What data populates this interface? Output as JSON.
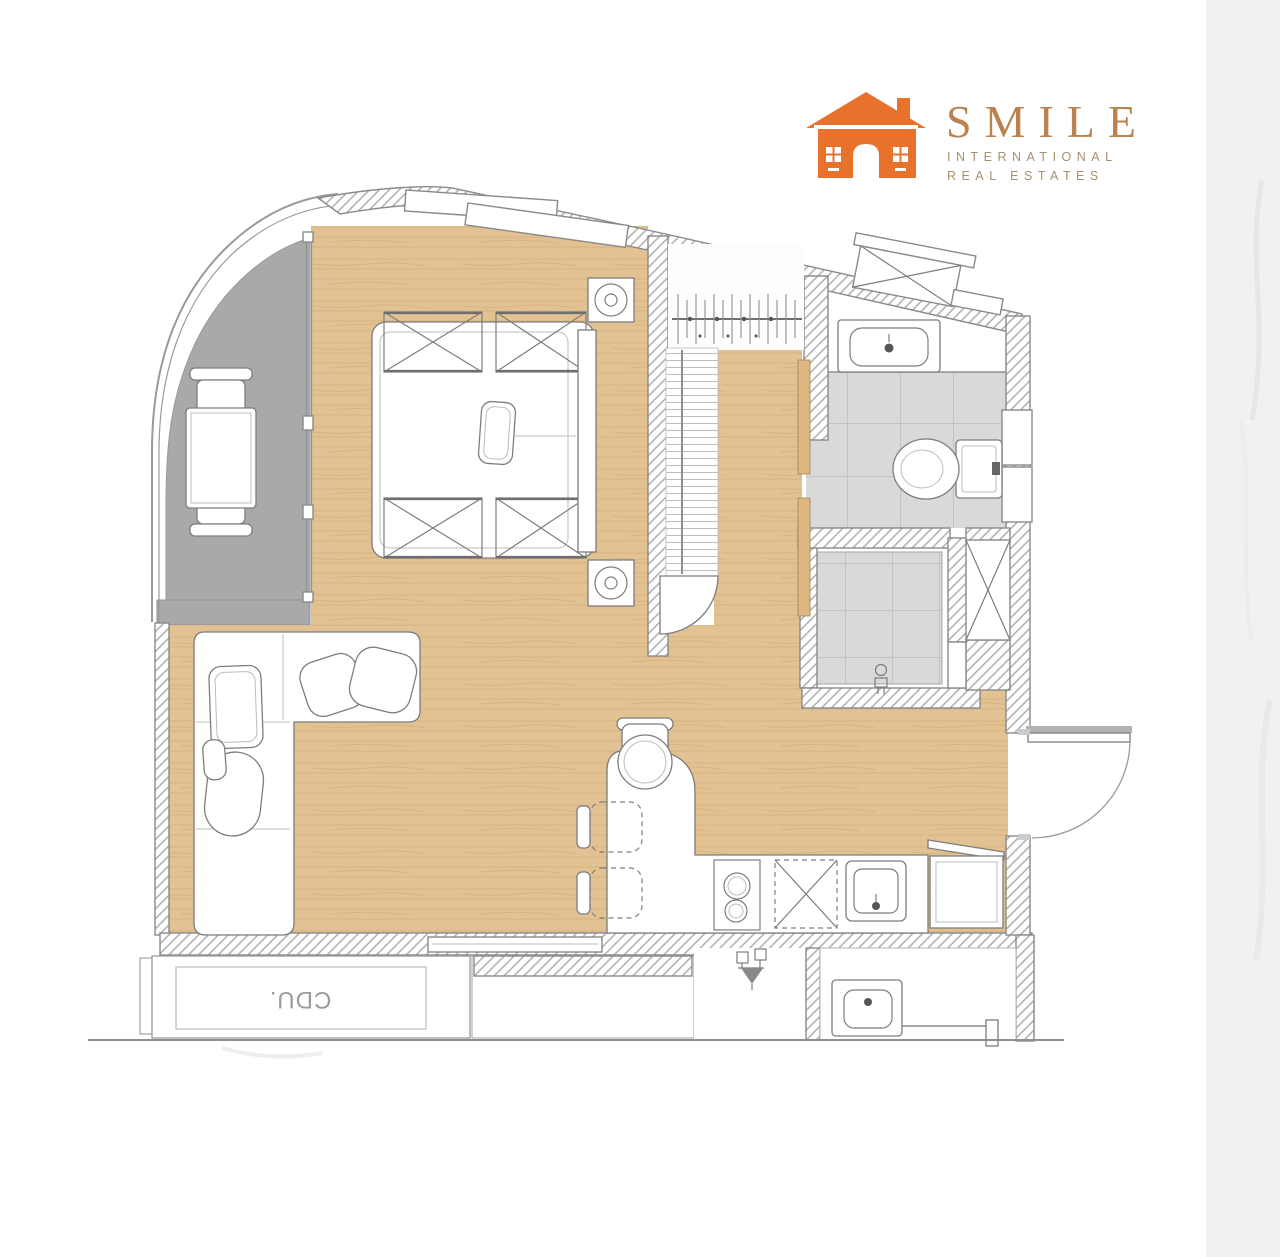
{
  "logo": {
    "name": "SMILE",
    "subtitle_line1": "INTERNATIONAL",
    "subtitle_line2": "REAL ESTATES",
    "colors": {
      "brand_orange": "#e8722c",
      "logo_text": "#b9824f",
      "logo_subtext": "#a8906f"
    }
  },
  "plan": {
    "labels": {
      "condensing_unit": "CDU."
    },
    "colors": {
      "wall_stroke": "#8a8a8a",
      "hatch_line": "#adadad",
      "drawing_line": "#7d7d7d",
      "wood_floor": "#e2c192",
      "wood_grain": "#cda76e",
      "balcony_floor": "#a9a9a9",
      "tile_floor": "#d9d9d9",
      "tile_grid": "#c3c3c3",
      "shelf_line": "#bdbdbd",
      "closet_panel": "#dcb77f",
      "marble_band": "#f1f1f2",
      "ground_line": "#8f8f8f"
    }
  }
}
